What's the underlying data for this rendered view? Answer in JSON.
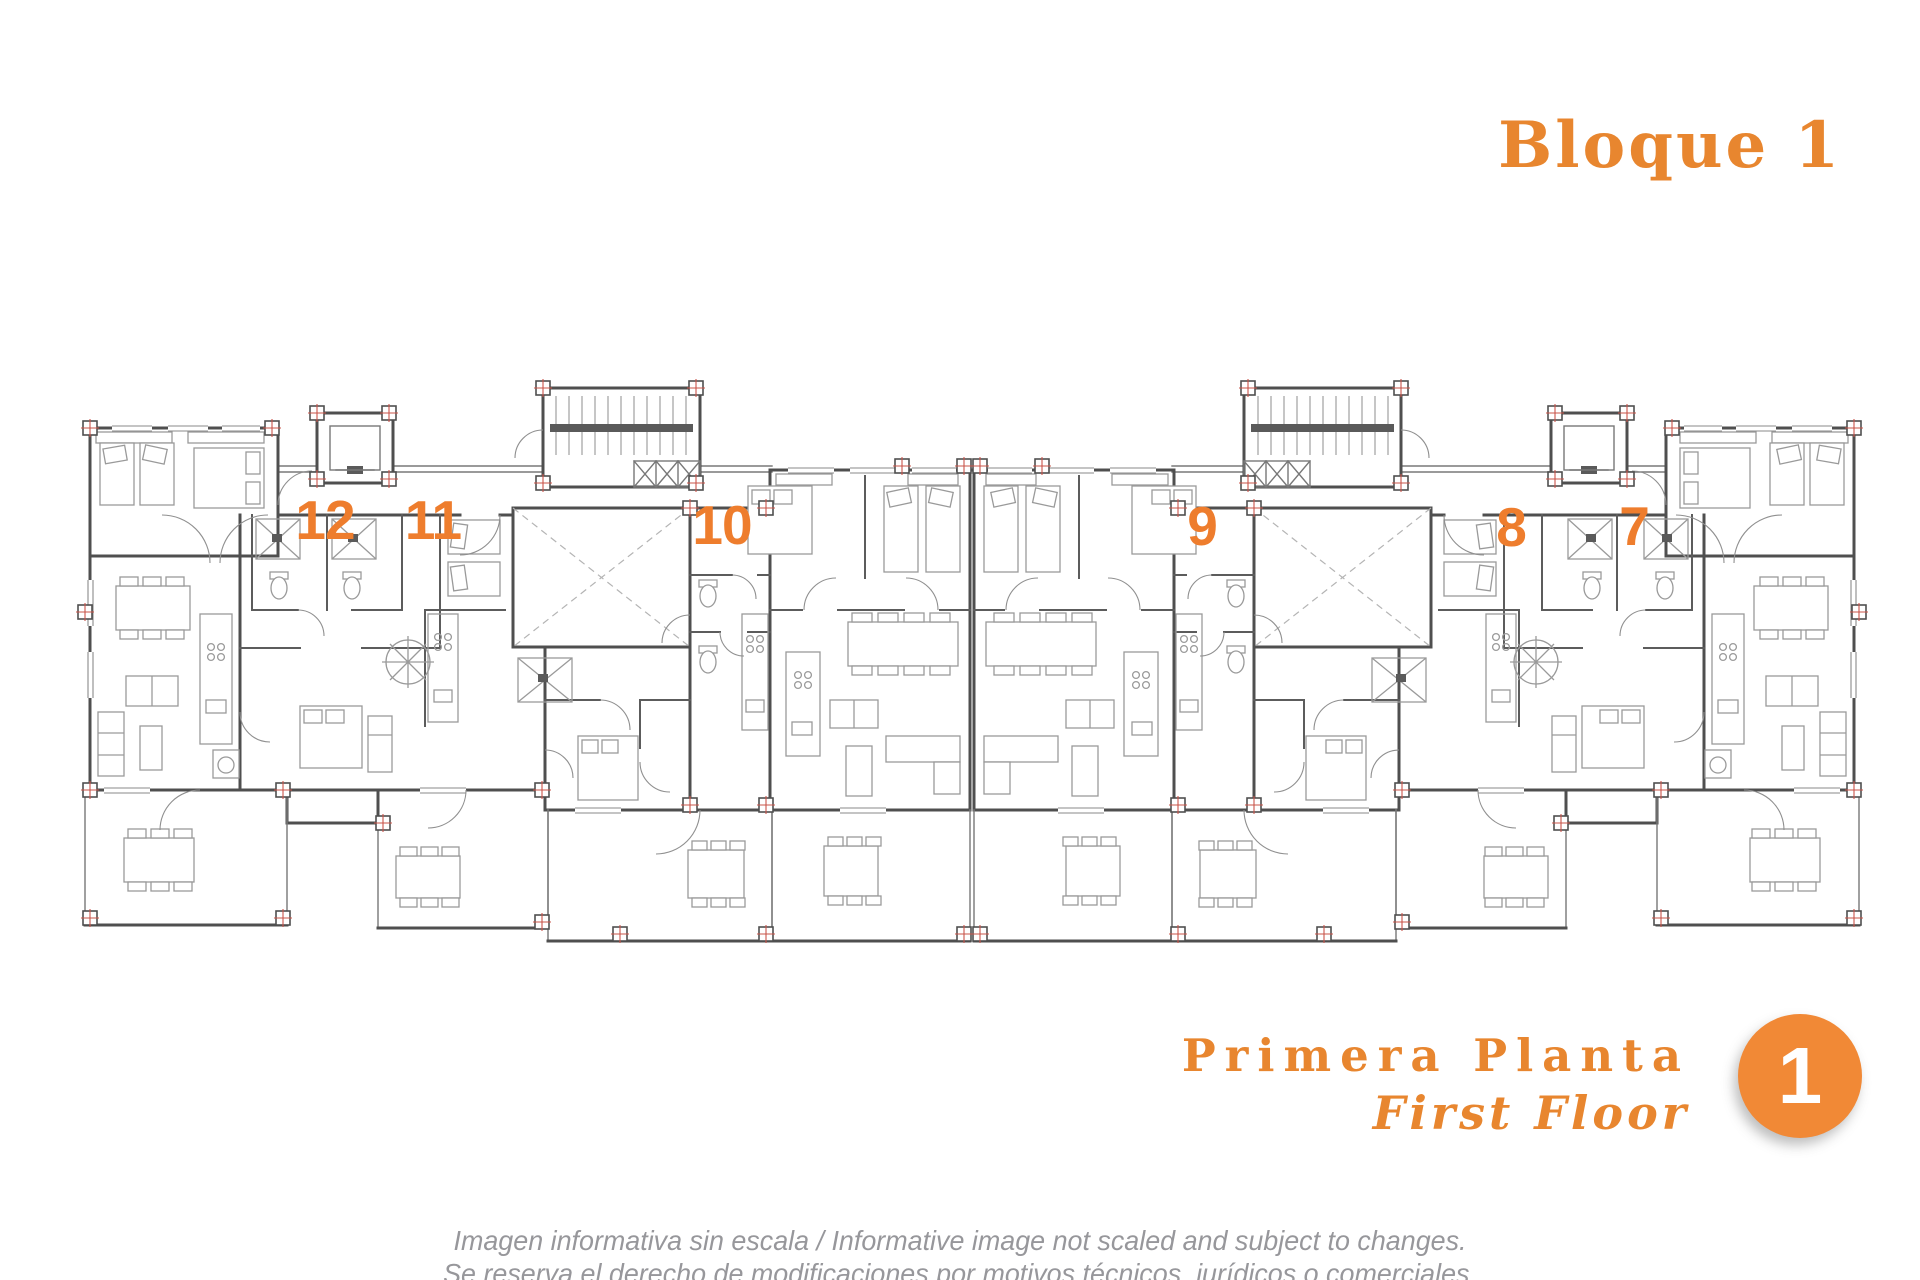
{
  "header": {
    "title": "Bloque 1"
  },
  "floor": {
    "primary": "Primera Planta",
    "secondary": "First Floor",
    "badge": "1"
  },
  "plan": {
    "units": [
      {
        "number": "12",
        "x": 325,
        "y": 520
      },
      {
        "number": "11",
        "x": 433,
        "y": 520
      },
      {
        "number": "10",
        "x": 722,
        "y": 525
      },
      {
        "number": "9",
        "x": 1202,
        "y": 526
      },
      {
        "number": "8",
        "x": 1511,
        "y": 527
      },
      {
        "number": "7",
        "x": 1634,
        "y": 526
      }
    ]
  },
  "disclaimer": {
    "line1": "Imagen informativa sin escala /  Informative image not scaled and subject to changes.",
    "line2": "Se reserva el derecho de modificaciones por motivos técnicos, jurídicos o comerciales."
  },
  "colors": {
    "accent_orange": "#e8862f",
    "unit_number_orange": "#ee7d2d",
    "badge_orange": "#f18936",
    "disclaimer_gray": "#97979b",
    "wall_gray": "#4f4f4f",
    "furniture_gray": "#9a9a9a",
    "column_marker_red": "#c9544a"
  }
}
